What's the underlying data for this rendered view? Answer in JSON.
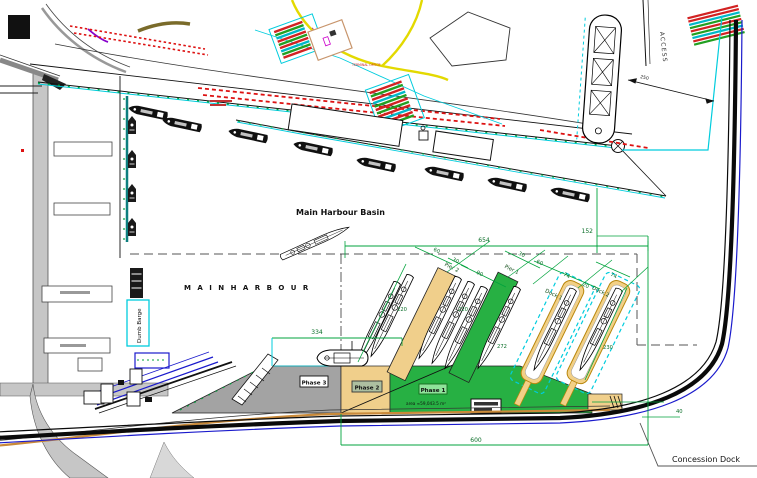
{
  "drawing": {
    "labels": {
      "main_harbour_basin": "Main Harbour Basin",
      "main_harbour": "M A I N   H A R B O U R",
      "concession_dock": "Concession Dock",
      "dumb_barge": "Dumb Barge",
      "access": "ACCESS",
      "terminal_office": "TERMINAL OFFICE",
      "pier_2": "Pier 2",
      "pier_1": "Pier 1",
      "dock_1": "Dock 1",
      "dock_2": "Dock 2",
      "phase_1": "Phase 1",
      "phase_2": "Phase 2",
      "phase_3": "Phase 3",
      "phase_1_area": "area ≈59,043.5 m²"
    },
    "dimensions": {
      "d654": "654",
      "d152": "152",
      "d334": "334",
      "d600": "600",
      "d40": "40",
      "d250": "250",
      "pier2_60": "60",
      "pier2_30": "30",
      "gap_90": "90",
      "pier2_len": "220",
      "pier1_len": "220",
      "pier1_tail": "272",
      "dock_30": "30",
      "dock_60": "60",
      "dock1_74": "74",
      "dock_gap_20": "20",
      "dock2_74": "74",
      "dock2_len": "230"
    },
    "colors": {
      "phase1_green": "#27b043",
      "phase2_tan": "#f0cf8b",
      "phase3_gray": "#a3a3a3",
      "dimension_green": "#00a33c",
      "boundary_cyan": "#00ccdd",
      "quay_teal": "#0e7f7f",
      "road_black": "#0a0a0a",
      "road_blue": "#1a1acc",
      "road_orange": "#c98a3a",
      "rail_red": "#dd1111",
      "road_yellow": "#e3d900"
    }
  }
}
